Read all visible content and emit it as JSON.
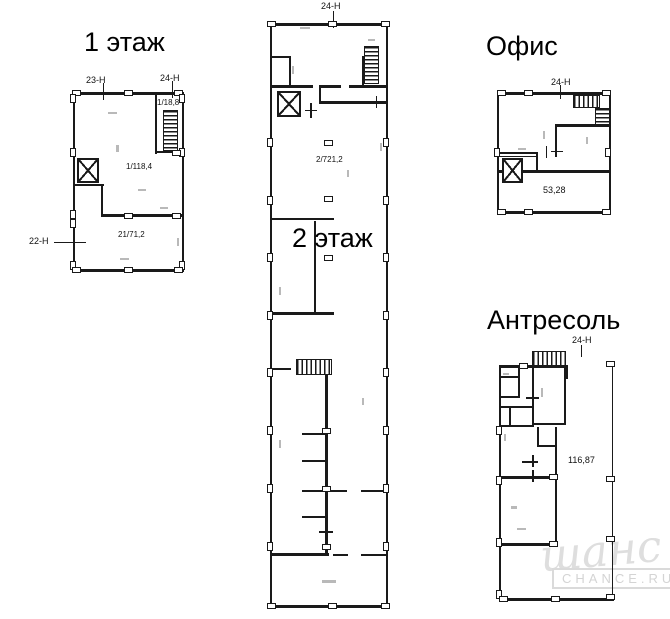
{
  "plans": {
    "floor1": {
      "title": "1 этаж",
      "axes": {
        "left": "22-Н",
        "top_left": "23-Н",
        "top_right": "24-Н"
      },
      "rooms": {
        "stairwell": "1/18,8",
        "main": "1/118,4",
        "lower": "21/71,2"
      }
    },
    "floor2": {
      "title": "2 этаж",
      "axes": {
        "top": "24-Н"
      },
      "rooms": {
        "main": "2/721,2"
      }
    },
    "office": {
      "title": "Офис",
      "axes": {
        "top": "24-Н"
      },
      "rooms": {
        "area": "53,28"
      }
    },
    "mezzanine": {
      "title": "Антресоль",
      "axes": {
        "top": "24-Н"
      },
      "rooms": {
        "area": "116,87"
      }
    }
  },
  "watermark": {
    "script": "шанс",
    "caption": "CHANCE.RU"
  },
  "colors": {
    "line": "#1a1a1a",
    "watermark": "#dedede"
  }
}
